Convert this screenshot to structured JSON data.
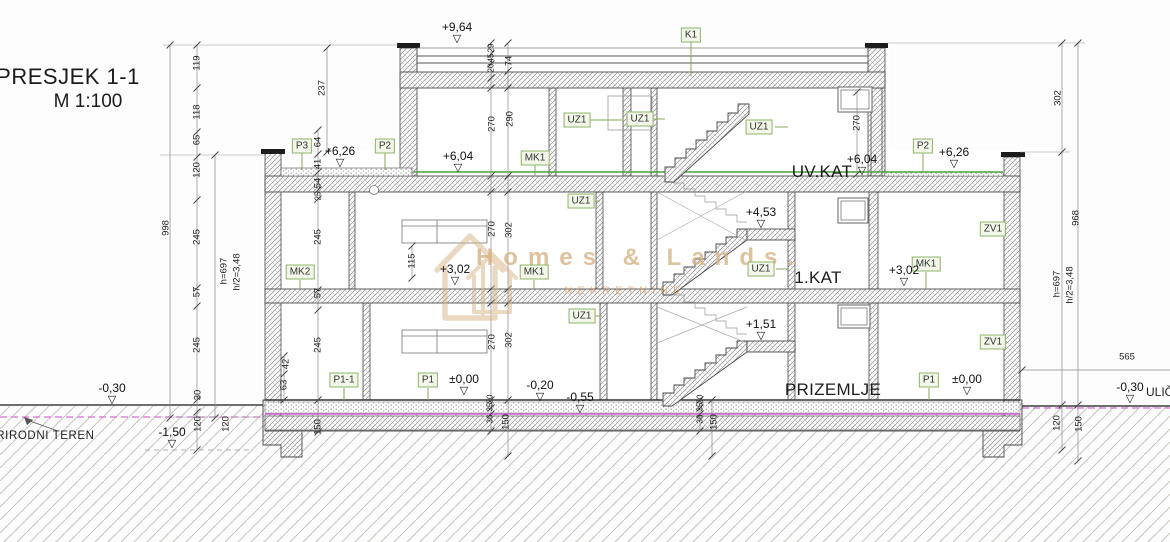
{
  "title": {
    "main": "PRESJEK 1-1",
    "scale": "M 1:100"
  },
  "watermark": {
    "brand": "Homes & Lands.",
    "tagline": "NEKRETNINE"
  },
  "terrain_label": "PRIRODNI TEREN",
  "street_label": "ULIČNI",
  "colors": {
    "tagB": "#8fb469",
    "tagBg": "#f2f7ea",
    "wm": "#d6b285",
    "wm2": "#e09a55",
    "floor_line_green": "#4aa03c",
    "ground_pink": "#cf5fcf"
  },
  "floor_labels": [
    {
      "text": "UV.KAT",
      "x": 822,
      "y": 172
    },
    {
      "text": "1.KAT",
      "x": 818,
      "y": 278
    },
    {
      "text": "PRIZEMLJE",
      "x": 833,
      "y": 390
    }
  ],
  "component_tags": [
    {
      "label": "K1",
      "x": 691,
      "y": 35
    },
    {
      "label": "P3",
      "x": 302,
      "y": 146
    },
    {
      "label": "P2",
      "x": 385,
      "y": 146
    },
    {
      "label": "P2",
      "x": 923,
      "y": 146
    },
    {
      "label": "UZ1",
      "x": 577,
      "y": 120
    },
    {
      "label": "UZ1",
      "x": 640,
      "y": 119
    },
    {
      "label": "UZ1",
      "x": 759,
      "y": 127
    },
    {
      "label": "MK1",
      "x": 535,
      "y": 158
    },
    {
      "label": "UZ1",
      "x": 581,
      "y": 201
    },
    {
      "label": "MK2",
      "x": 300,
      "y": 272
    },
    {
      "label": "MK1",
      "x": 534,
      "y": 272
    },
    {
      "label": "UZ1",
      "x": 761,
      "y": 269
    },
    {
      "label": "MK1",
      "x": 926,
      "y": 264
    },
    {
      "label": "ZV1",
      "x": 993,
      "y": 229
    },
    {
      "label": "ZV1",
      "x": 993,
      "y": 342
    },
    {
      "label": "UZ1",
      "x": 582,
      "y": 316
    },
    {
      "label": "P1-1",
      "x": 344,
      "y": 380
    },
    {
      "label": "P1",
      "x": 428,
      "y": 380
    },
    {
      "label": "P1",
      "x": 929,
      "y": 380
    }
  ],
  "level_markers": [
    {
      "value": "+9,64",
      "x": 457,
      "y": 31
    },
    {
      "value": "+6,26",
      "x": 340,
      "y": 155
    },
    {
      "value": "+6,04",
      "x": 458,
      "y": 160
    },
    {
      "value": "+6,04",
      "x": 862,
      "y": 163
    },
    {
      "value": "+6,26",
      "x": 954,
      "y": 156
    },
    {
      "value": "+4,53",
      "x": 761,
      "y": 216
    },
    {
      "value": "+3,02",
      "x": 455,
      "y": 273
    },
    {
      "value": "+3,02",
      "x": 904,
      "y": 274
    },
    {
      "value": "+1,51",
      "x": 761,
      "y": 328
    },
    {
      "value": "±0,00",
      "x": 464,
      "y": 383
    },
    {
      "value": "±0,00",
      "x": 967,
      "y": 383
    },
    {
      "value": "-0,20",
      "x": 540,
      "y": 389
    },
    {
      "value": "-0,55",
      "x": 580,
      "y": 401
    },
    {
      "value": "-0,30",
      "x": 112,
      "y": 392
    },
    {
      "value": "-0,30",
      "x": 1130,
      "y": 391
    },
    {
      "value": "-1,50",
      "x": 172,
      "y": 436
    }
  ],
  "dim_labels": [
    {
      "text": "998",
      "x": 166,
      "y": 228,
      "rot": 1
    },
    {
      "text": "119",
      "x": 197,
      "y": 63,
      "rot": 1
    },
    {
      "text": "118",
      "x": 197,
      "y": 112,
      "rot": 1
    },
    {
      "text": "65",
      "x": 197,
      "y": 140,
      "rot": 1
    },
    {
      "text": "120",
      "x": 197,
      "y": 170,
      "rot": 1
    },
    {
      "text": "245",
      "x": 197,
      "y": 237,
      "rot": 1
    },
    {
      "text": "57",
      "x": 197,
      "y": 292,
      "rot": 1
    },
    {
      "text": "245",
      "x": 197,
      "y": 345,
      "rot": 1
    },
    {
      "text": "30",
      "x": 198,
      "y": 395,
      "rot": 1
    },
    {
      "text": "120",
      "x": 198,
      "y": 424,
      "rot": 1
    },
    {
      "text": "120",
      "x": 226,
      "y": 424,
      "rot": 1
    },
    {
      "text": "h=697",
      "x": 224,
      "y": 271,
      "rot": 1
    },
    {
      "text": "h/2=3,48",
      "x": 237,
      "y": 272,
      "rot": 1
    },
    {
      "text": "237",
      "x": 322,
      "y": 88,
      "rot": 1
    },
    {
      "text": "64",
      "x": 318,
      "y": 142,
      "rot": 1
    },
    {
      "text": "41",
      "x": 318,
      "y": 164,
      "rot": 1
    },
    {
      "text": "54",
      "x": 318,
      "y": 183,
      "rot": 1
    },
    {
      "text": "25",
      "x": 318,
      "y": 196,
      "rot": 1,
      "s": 8
    },
    {
      "text": "245",
      "x": 318,
      "y": 237,
      "rot": 1
    },
    {
      "text": "57",
      "x": 318,
      "y": 293,
      "rot": 1
    },
    {
      "text": "245",
      "x": 318,
      "y": 345,
      "rot": 1
    },
    {
      "text": "150",
      "x": 318,
      "y": 427,
      "rot": 1
    },
    {
      "text": "42",
      "x": 286,
      "y": 364,
      "rot": 1
    },
    {
      "text": "63",
      "x": 284,
      "y": 385,
      "rot": 1
    },
    {
      "text": "115",
      "x": 412,
      "y": 261,
      "rot": 1
    },
    {
      "text": "29",
      "x": 491,
      "y": 48,
      "rot": 1,
      "s": 8
    },
    {
      "text": "45",
      "x": 491,
      "y": 58,
      "rot": 1,
      "s": 8
    },
    {
      "text": "20",
      "x": 491,
      "y": 68,
      "rot": 1,
      "s": 8
    },
    {
      "text": "74",
      "x": 509,
      "y": 61,
      "rot": 1
    },
    {
      "text": "270",
      "x": 492,
      "y": 124,
      "rot": 1
    },
    {
      "text": "290",
      "x": 510,
      "y": 119,
      "rot": 1
    },
    {
      "text": "270",
      "x": 492,
      "y": 229,
      "rot": 1
    },
    {
      "text": "302",
      "x": 509,
      "y": 230,
      "rot": 1
    },
    {
      "text": "270",
      "x": 492,
      "y": 342,
      "rot": 1
    },
    {
      "text": "302",
      "x": 509,
      "y": 340,
      "rot": 1
    },
    {
      "text": "20",
      "x": 490,
      "y": 399,
      "rot": 1,
      "s": 8
    },
    {
      "text": "35",
      "x": 490,
      "y": 407,
      "rot": 1,
      "s": 8
    },
    {
      "text": "36",
      "x": 490,
      "y": 419,
      "rot": 1,
      "s": 8
    },
    {
      "text": "150",
      "x": 506,
      "y": 422,
      "rot": 1
    },
    {
      "text": "20",
      "x": 700,
      "y": 399,
      "rot": 1,
      "s": 8
    },
    {
      "text": "35",
      "x": 700,
      "y": 407,
      "rot": 1,
      "s": 8
    },
    {
      "text": "36",
      "x": 700,
      "y": 419,
      "rot": 1,
      "s": 8
    },
    {
      "text": "150",
      "x": 714,
      "y": 422,
      "rot": 1
    },
    {
      "text": "270",
      "x": 857,
      "y": 123,
      "rot": 1
    },
    {
      "text": "302",
      "x": 1058,
      "y": 98,
      "rot": 1
    },
    {
      "text": "968",
      "x": 1076,
      "y": 218,
      "rot": 1
    },
    {
      "text": "h=697",
      "x": 1057,
      "y": 284,
      "rot": 1
    },
    {
      "text": "h/2=3,48",
      "x": 1070,
      "y": 285,
      "rot": 1
    },
    {
      "text": "120",
      "x": 1057,
      "y": 423,
      "rot": 1
    },
    {
      "text": "150",
      "x": 1079,
      "y": 424,
      "rot": 1
    },
    {
      "text": "565",
      "x": 1127,
      "y": 357,
      "rot": 0
    }
  ]
}
